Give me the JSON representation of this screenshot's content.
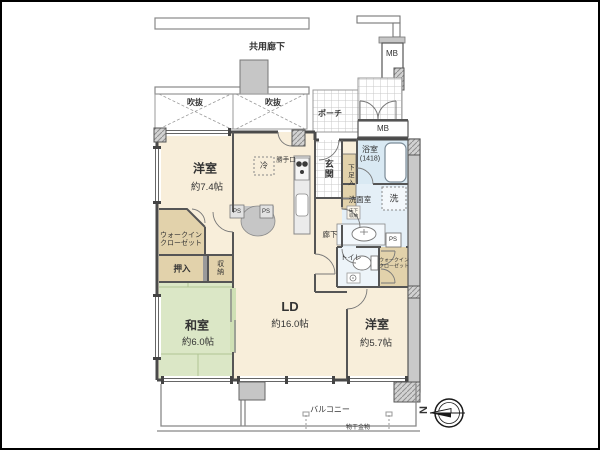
{
  "floor_plan": {
    "common_areas": {
      "shared_corridor": "共用廊下",
      "void_open_space": "吹抜",
      "porch": "ポーチ",
      "meter_box": "MB"
    },
    "rooms": {
      "bedroom_w74": {
        "name": "洋室",
        "size": "約7.4帖"
      },
      "bedroom_w57": {
        "name": "洋室",
        "size": "約5.7帖"
      },
      "japanese_room": {
        "name": "和室",
        "size": "約6.0帖"
      },
      "living_dining": {
        "name": "LD",
        "size": "約16.0帖"
      },
      "bathroom": {
        "name": "浴室",
        "size": "(1418)"
      },
      "washroom": "洗面室",
      "toilet": "トイレ",
      "hallway": "廊下",
      "entrance": "玄関"
    },
    "storage": {
      "walkin_closet_line1": "ウォークイン",
      "walkin_closet_line2": "クローゼット",
      "oshiire": "押入",
      "closet": "収納",
      "shoe_box": "下足入",
      "underfloor_line1": "床下",
      "underfloor_line2": "収納"
    },
    "fixtures": {
      "refrigerator": "冷",
      "washer": "洗",
      "back_door": "勝手口",
      "pipe_space": "PS"
    },
    "balcony": {
      "label": "バルコニー",
      "drying_fixture": "物干金物"
    },
    "compass": {
      "north": "N"
    }
  },
  "colors": {
    "room_cream": "#f8eeda",
    "tatami_green": "#dbe7c6",
    "closet_tan": "#e2d2ab",
    "water_blue": "#d9e9f3",
    "wall_gray": "#4a4a4a",
    "column_gray": "#c6c6c6"
  }
}
